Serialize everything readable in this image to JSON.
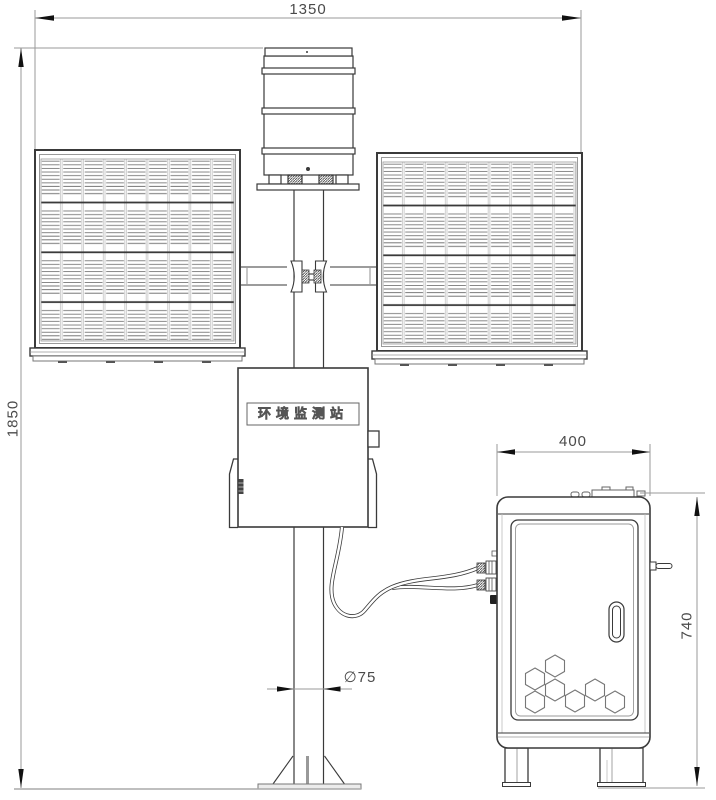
{
  "drawing": {
    "type": "technical drawing - environmental monitoring station",
    "dimensions": {
      "top_width": "1350",
      "overall_height": "1850",
      "pole_diameter": "∅75",
      "cabinet_width": "400",
      "cabinet_height": "740"
    },
    "labels": {
      "station_nameplate": "环境监测站"
    },
    "colors": {
      "structure_line": "#3a3a3a",
      "dimension_line": "#9a9a9a",
      "arrowhead": "#111111",
      "hatch_line": "#777777",
      "label_text": "#4a4a4a"
    }
  }
}
